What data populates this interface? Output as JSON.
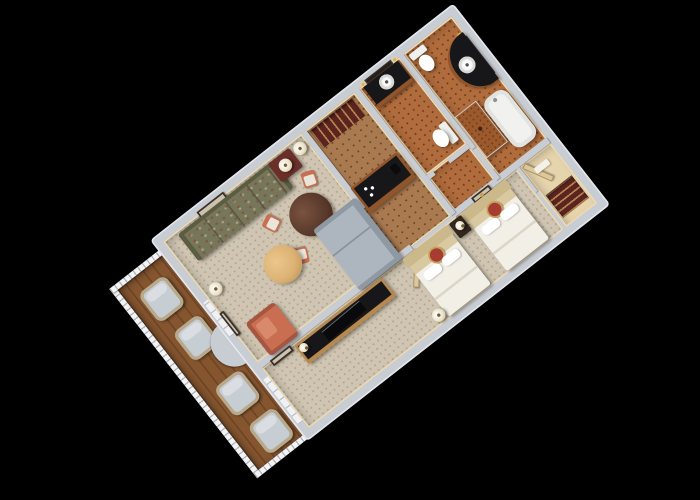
{
  "scene": {
    "type": "3d-floor-plan-render",
    "description": "Photorealistic isometric 3D rendering of a hotel suite floor plan, rotated diagonally on a solid black background. No text, labels or UI controls are visible in the image.",
    "rotation_deg": -38,
    "background": "#000000"
  },
  "palette": {
    "bg": "#000000",
    "wallTop": "#c8ccd3",
    "wallOuter": "#e4e7ec",
    "cream": "#ead9b6",
    "carpet": "#cfc5b2",
    "carpetDot": "#b3a68c",
    "wood": "#a97a50",
    "woodDot": "#6b4526",
    "tile": "#b06c3c",
    "tileDot": "#6e3d1c",
    "balconyWood": "#84552f",
    "balconyWoodDark": "#6f4525",
    "railing": "#f2f3f5",
    "sofaGreen": "#75765a",
    "sofaGreenDark": "#5c5c42",
    "loveseatGray": "#adb6bf",
    "loveseatGrayDark": "#8e99a4",
    "ottomanTan": "#dcb274",
    "coral": "#c96e50",
    "seatWhite": "#e9e5da",
    "tableWood": "#57382a",
    "maroon": "#6b2f2a",
    "closetMaroon": "#5d241f",
    "consoleWood": "#b8894e",
    "counterBlack": "#17171a",
    "bedWhite": "#f2efe7",
    "bedShadow": "#dcd6c8",
    "headboardBeige": "#d8c9a0",
    "medallionRed": "#a63c32",
    "medallionGold": "#c9a156",
    "mirrorDark": "#241c14",
    "lampShade": "#ece2c8",
    "wicker": "#b9a98c",
    "cushion": "#c6cdd3",
    "sconceGold": "#d8b25e",
    "woodCab": "#91552c",
    "tubWhite": "#f1f2f0"
  },
  "rooms": [
    {
      "id": "living-room",
      "label": "Living room",
      "floor": "beige carpet with dot grid",
      "furniture": [
        "green patterned sofa",
        "framed picture above sofa",
        "maroon side chest with table lamp",
        "two floor lamps",
        "round dark-wood dining table",
        "four coral dining chairs with white seats",
        "round tan ottoman",
        "gray loveseat",
        "coral armchair",
        "picture on side wall"
      ]
    },
    {
      "id": "balcony",
      "label": "Balcony",
      "floor": "brown wood planks",
      "furniture": [
        "four wicker chairs with gray cushions",
        "white railing with balusters",
        "curved wall bay at the doors"
      ]
    },
    {
      "id": "entry-corridor",
      "label": "Entry corridor",
      "floor": "wood with dot pattern",
      "furniture": [
        "maroon entry closet with hanging rod",
        "wet bar with dark counter, coffee maker and glasses"
      ]
    },
    {
      "id": "bathroom-1",
      "label": "Bathroom 1",
      "floor": "terracotta tile",
      "furniture": [
        "dark vanity with round white sink",
        "wall mirror",
        "gold sconces",
        "toilet"
      ]
    },
    {
      "id": "bathroom-2",
      "label": "Bathroom 2",
      "floor": "terracotta tile",
      "furniture": [
        "curved dark vanity with round white sink",
        "wall mirror",
        "gold sconces",
        "toilet",
        "brown tiled shower",
        "white bathtub"
      ]
    },
    {
      "id": "bedroom",
      "label": "Bedroom",
      "floor": "beige carpet with dot grid",
      "furniture": [
        "two double beds with white bedding, beige headboards and red-gold medallion pillows",
        "dark nightstand with lamp",
        "wood TV console with black top and television",
        "console lamp",
        "floor lamp",
        "open door leaves",
        "gold-framed picture",
        "picture on divider wall"
      ]
    },
    {
      "id": "bedroom-closet",
      "label": "Bedroom closet",
      "floor": "cream",
      "furniture": [
        "maroon hanging rail with hangers",
        "closet door"
      ]
    }
  ]
}
